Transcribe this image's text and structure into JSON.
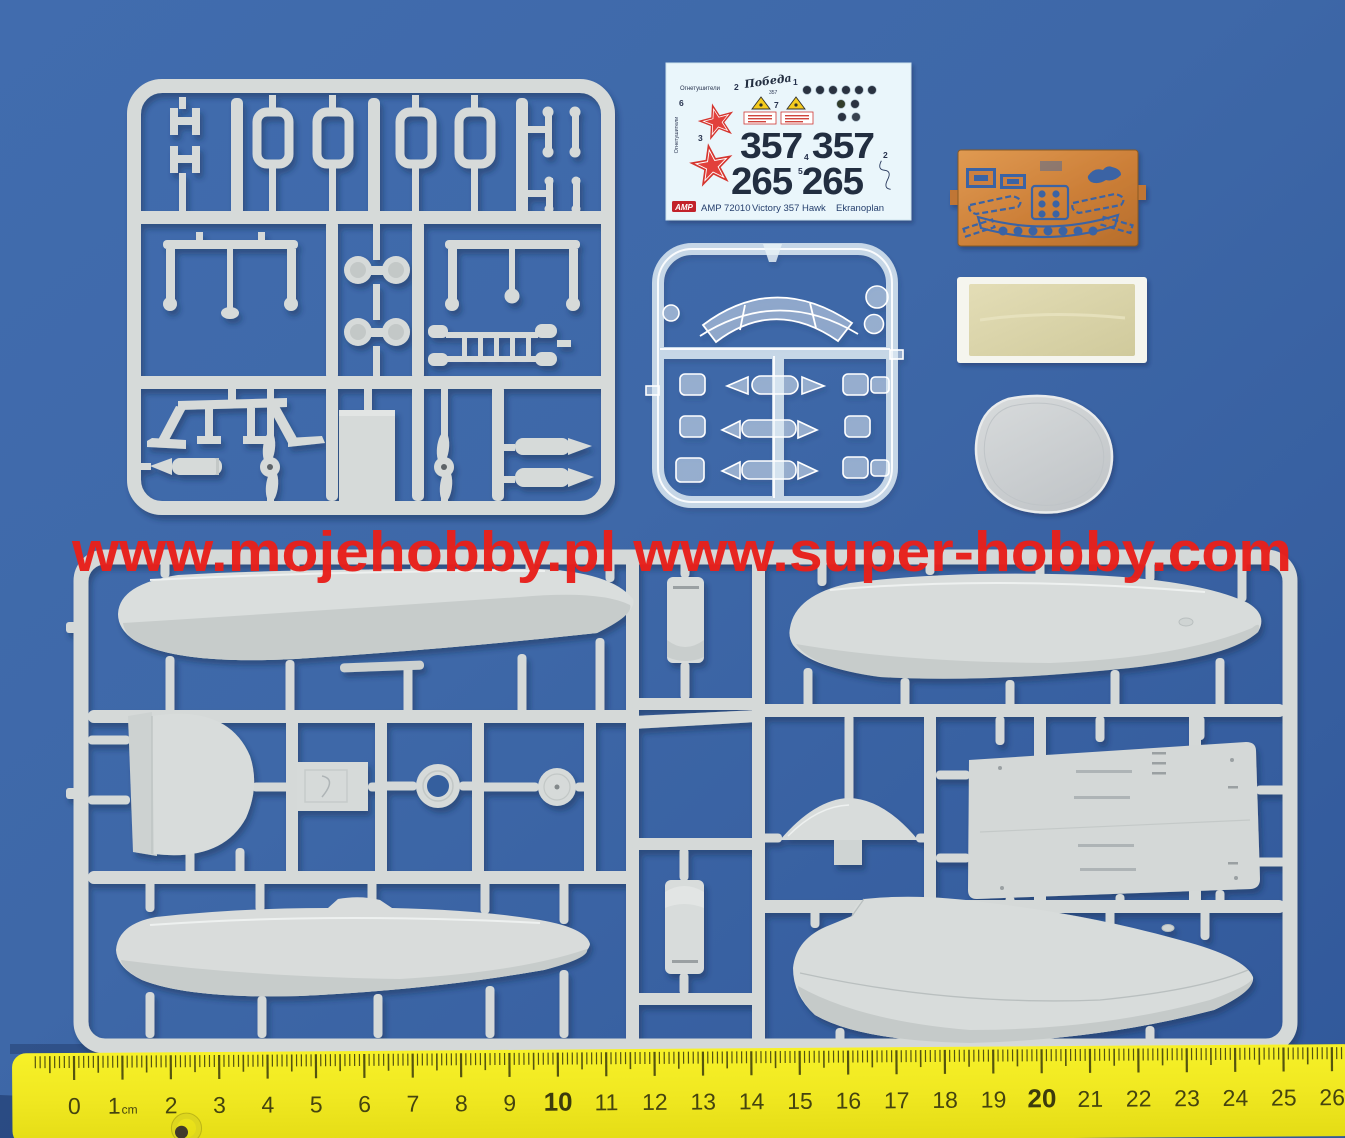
{
  "watermark": {
    "text": "www.mojehobby.pl www.super-hobby.com",
    "color": "#e8201b"
  },
  "decal_sheet": {
    "fire_extinguisher_label": "Огнетушители",
    "fire_extinguisher_qty": "2",
    "fire_extinguisher_vertical_label": "Огнетушители",
    "fire_extinguisher_vertical_qty": "6",
    "signature": "Победа",
    "signature_number": "357",
    "gauges_qty": "1",
    "star_qty": "3",
    "triangle_qty": "7",
    "bort_number_row1": "357 357",
    "bort_number_row1_qty": "4",
    "bort_number_row2": "265 265",
    "bort_number_row2_qty": "5",
    "side_qty": "2",
    "brand_logo": "AMP",
    "kit_code": "AMP 72010",
    "kit_name": "Victory 357 Hawk",
    "kit_type": "Ekranoplan"
  },
  "ruler": {
    "numbers": [
      "0",
      "1",
      "2",
      "3",
      "4",
      "5",
      "6",
      "7",
      "8",
      "9",
      "10",
      "11",
      "12",
      "13",
      "14",
      "15",
      "16",
      "17",
      "18",
      "19",
      "20",
      "21",
      "22",
      "23",
      "24",
      "25",
      "26"
    ],
    "unit_label": "cm",
    "bold_numbers": [
      "10",
      "20"
    ]
  },
  "colors": {
    "background_blue": "#3e68a8",
    "sprue_grey": "#d6dad9",
    "sprue_grey_shade": "#c6cbca",
    "clear_sprue": "#e8f2fa",
    "decal_paper": "#eaf6fb",
    "decal_ink_navy": "#232d40",
    "decal_red": "#d8232a",
    "warning_yellow": "#f5cb1e",
    "photo_etch_copper": "#cd8140",
    "film_khaki": "#d8d3ab",
    "resin_grey": "#ccd0d3",
    "ruler_yellow": "#f0e821",
    "watermark_red": "#e8201b"
  }
}
